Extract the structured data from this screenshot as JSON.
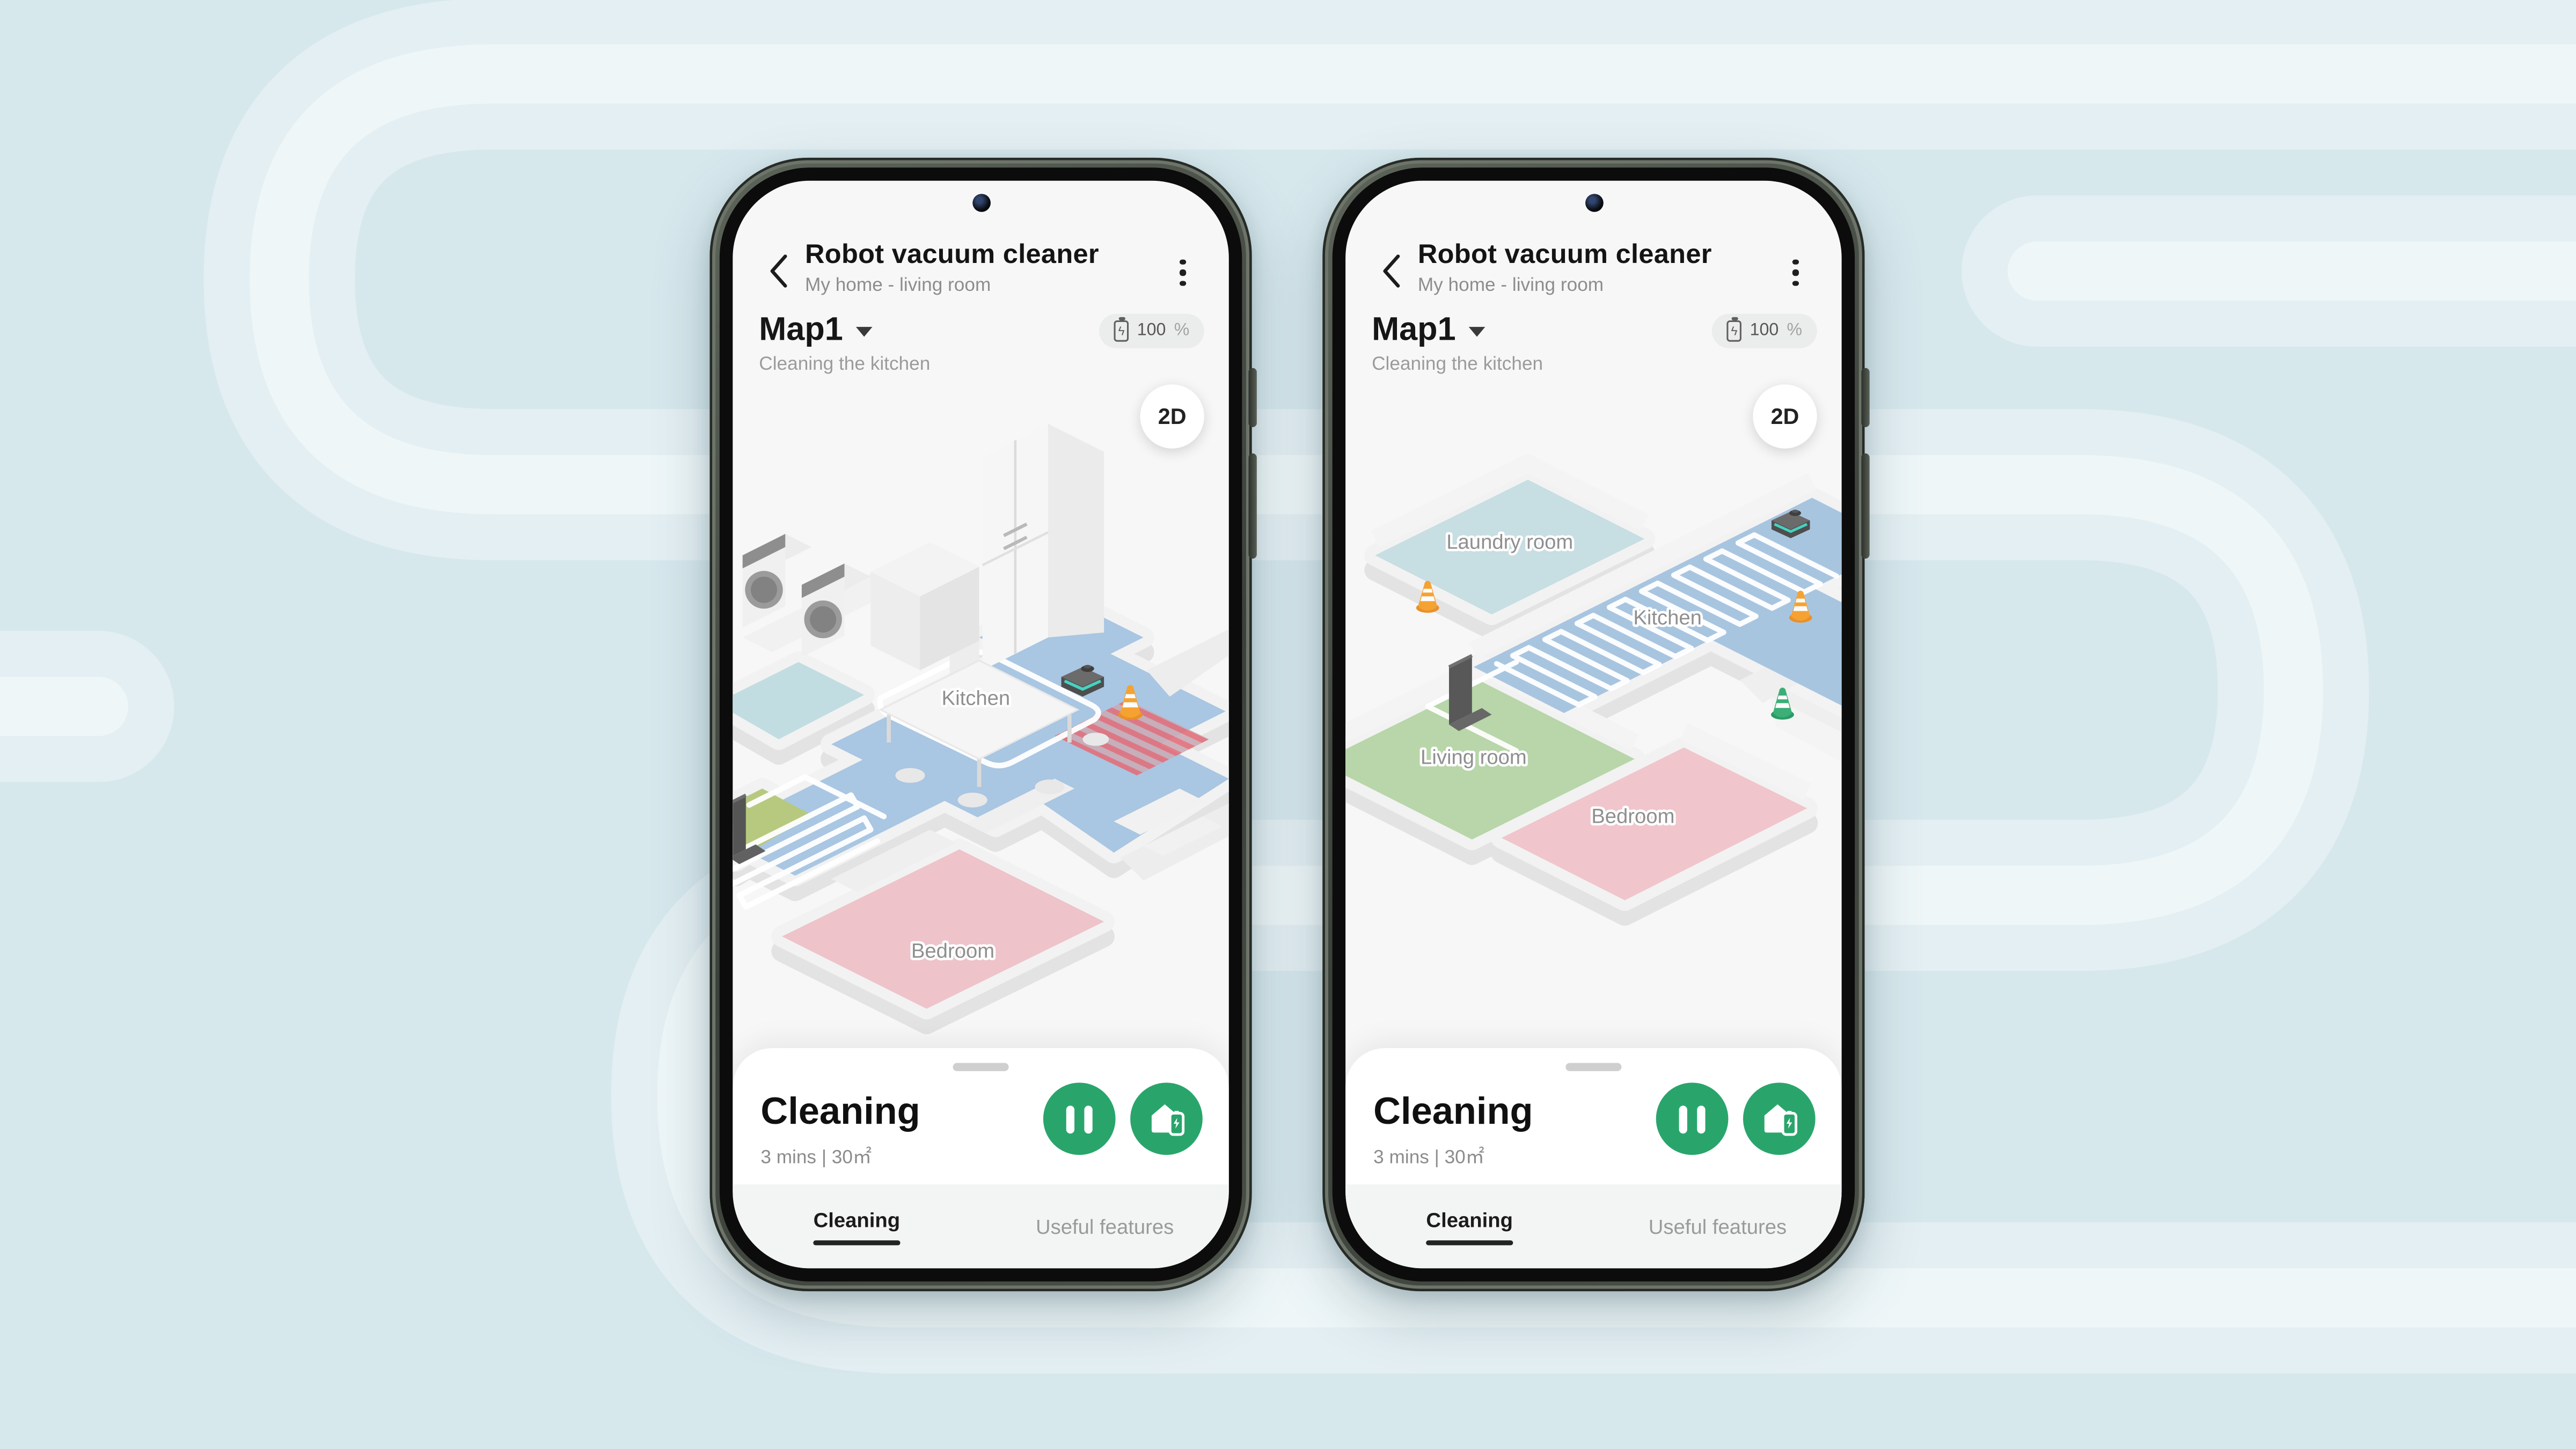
{
  "background": {
    "base_color": "#d7e8ed",
    "band_outer_color": "#e4eff3",
    "band_inner_color": "#eef6f8",
    "motif": "rounded serpentine vacuum-path bands"
  },
  "accent_green": "#29a56c",
  "phones": [
    {
      "side": "left",
      "header": {
        "title": "Robot vacuum cleaner",
        "subtitle": "My home - living room"
      },
      "toolbar": {
        "map_name": "Map1",
        "battery_value": "100",
        "battery_unit": "%",
        "status": "Cleaning the kitchen",
        "view_toggle": "2D"
      },
      "map": {
        "view": "3D zoomed-in isometric floor map",
        "rooms": [
          {
            "name": "Kitchen"
          },
          {
            "name": "Bedroom"
          }
        ],
        "objects": [
          "robot-vacuum",
          "charging-dock",
          "traffic-cone-orange",
          "no-go-zone-striped",
          "washer-dryer",
          "refrigerator",
          "dining-table",
          "cleaning-path"
        ]
      },
      "sheet": {
        "title": "Cleaning",
        "meta": "3 mins | 30㎡"
      },
      "tabs": [
        {
          "label": "Cleaning",
          "active": true
        },
        {
          "label": "Useful features",
          "active": false
        }
      ]
    },
    {
      "side": "right",
      "header": {
        "title": "Robot vacuum cleaner",
        "subtitle": "My home - living room"
      },
      "toolbar": {
        "map_name": "Map1",
        "battery_value": "100",
        "battery_unit": "%",
        "status": "Cleaning the kitchen",
        "view_toggle": "2D"
      },
      "map": {
        "view": "3D zoomed-out isometric floor map",
        "rooms": [
          {
            "name": "Laundry room"
          },
          {
            "name": "Kitchen"
          },
          {
            "name": "Living room"
          },
          {
            "name": "Bedroom"
          }
        ],
        "objects": [
          "robot-vacuum",
          "charging-dock",
          "traffic-cone-orange",
          "traffic-cone-orange",
          "traffic-cone-green",
          "cleaning-path"
        ]
      },
      "sheet": {
        "title": "Cleaning",
        "meta": "3 mins | 30㎡"
      },
      "tabs": [
        {
          "label": "Cleaning",
          "active": true
        },
        {
          "label": "Useful features",
          "active": false
        }
      ]
    }
  ]
}
